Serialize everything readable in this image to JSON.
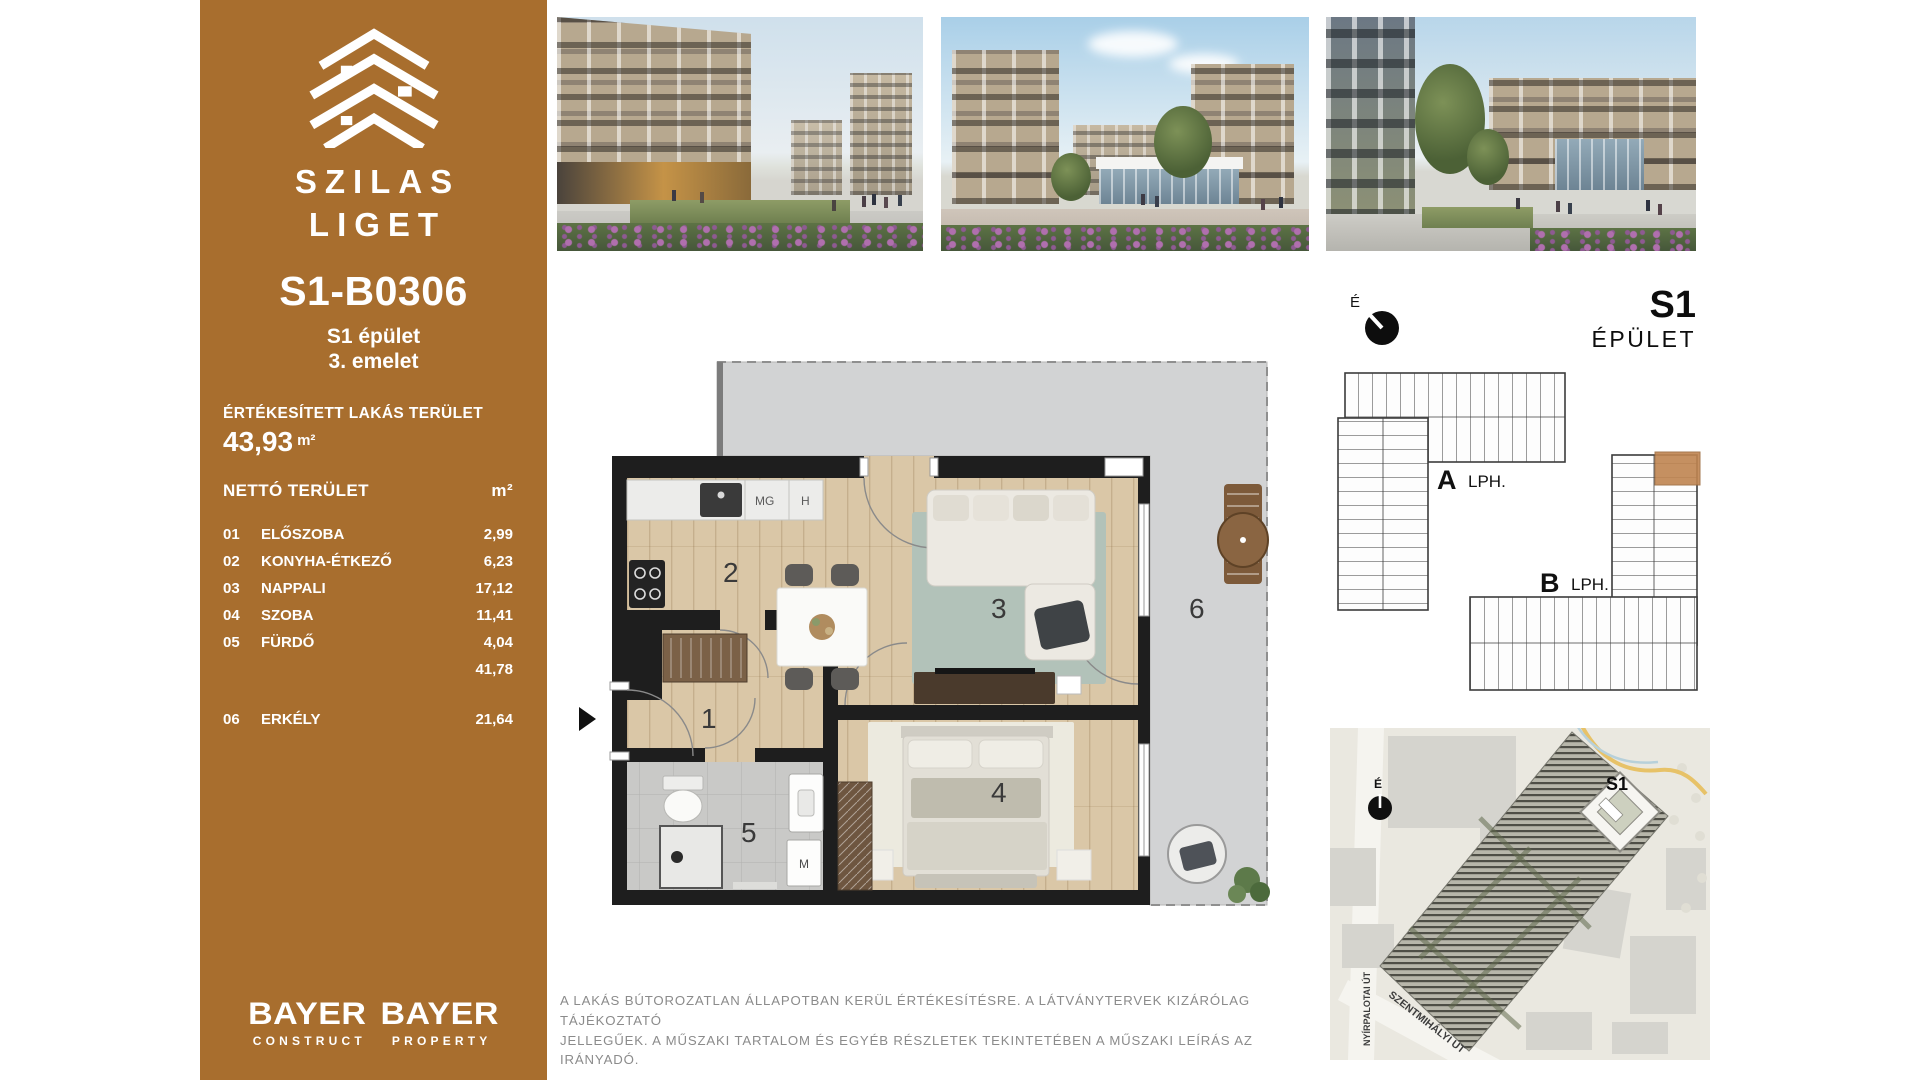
{
  "brand": {
    "line1": "SZILAS",
    "line2": "LIGET"
  },
  "unit": {
    "id": "S1-B0306",
    "building": "S1 épület",
    "floor": "3. emelet"
  },
  "sold_area": {
    "label": "ÉRTÉKESÍTETT LAKÁS TERÜLET",
    "value": "43,93",
    "unit": "m²"
  },
  "net_area": {
    "label": "NETTÓ TERÜLET",
    "unit_header": "m²",
    "rows": [
      {
        "num": "01",
        "name": "ELŐSZOBA",
        "area": "2,99"
      },
      {
        "num": "02",
        "name": "KONYHA-ÉTKEZŐ",
        "area": "6,23"
      },
      {
        "num": "03",
        "name": "NAPPALI",
        "area": "17,12"
      },
      {
        "num": "04",
        "name": "SZOBA",
        "area": "11,41"
      },
      {
        "num": "05",
        "name": "FÜRDŐ",
        "area": "4,04"
      }
    ],
    "subtotal": "41,78",
    "balcony_row": {
      "num": "06",
      "name": "ERKÉLY",
      "area": "21,64"
    }
  },
  "developers": [
    {
      "name": "BAYER",
      "division": "CONSTRUCT"
    },
    {
      "name": "BAYER",
      "division": "PROPERTY"
    }
  ],
  "building_header": {
    "north": "É",
    "name": "S1",
    "type": "ÉPÜLET"
  },
  "overview": {
    "stair_a": "A",
    "stair_a_type": "LPH.",
    "stair_b": "B",
    "stair_b_type": "LPH."
  },
  "floor_plan": {
    "room_numbers": {
      "hall": "1",
      "kitchen": "2",
      "living": "3",
      "bedroom": "4",
      "bath": "5",
      "balcony": "6"
    },
    "appliances": {
      "mg": "MG",
      "h": "H",
      "m": "M"
    }
  },
  "site_map": {
    "north": "É",
    "building": "S1",
    "street_vertical": "NYÍRPALOTAI ÚT",
    "street_diagonal": "SZENTMIHÁLYI ÚT"
  },
  "disclaimer": {
    "line1": "A LAKÁS BÚTOROZATLAN ÁLLAPOTBAN KERÜL ÉRTÉKESÍTÉSRE. A LÁTVÁNYTERVEK KIZÁRÓLAG TÁJÉKOZTATÓ",
    "line2": "JELLEGŰEK. A MŰSZAKI TARTALOM ÉS EGYÉB RÉSZLETEK TEKINTETÉBEN A MŰSZAKI LEÍRÁS AZ IRÁNYADÓ."
  },
  "colors": {
    "sidebar": "#A86E2E",
    "wall": "#1E1E1E",
    "wood_floor": "#D9C6A6",
    "balcony_concrete": "#D2D3D4",
    "unit_highlight": "#C08551",
    "map_background": "#EAE8E0",
    "disclaimer_text": "#8B8B8B"
  }
}
